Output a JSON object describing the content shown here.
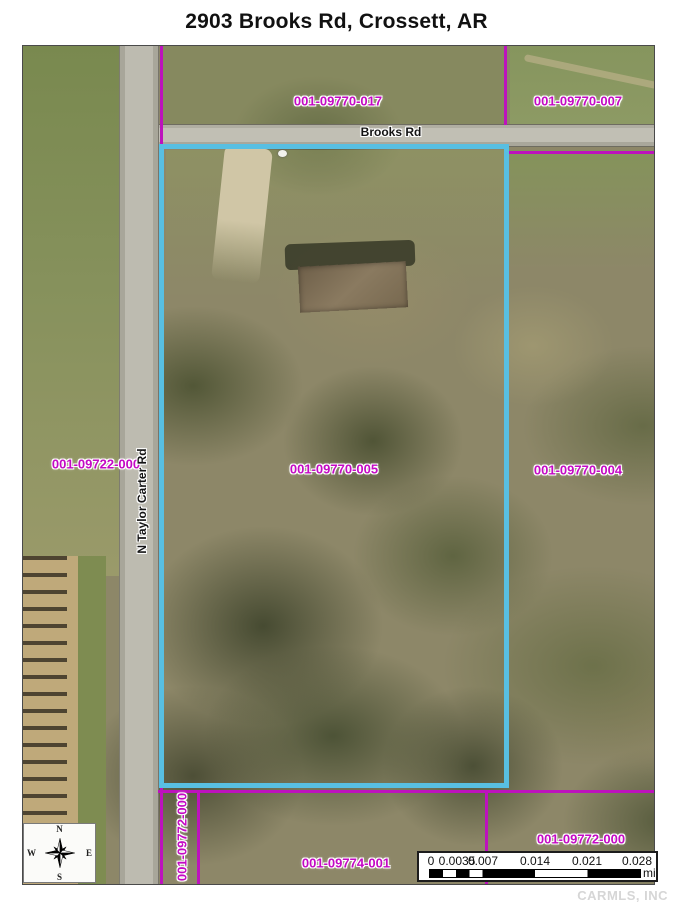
{
  "title": "2903 Brooks Rd, Crossett, AR",
  "parcels": {
    "topleft": "001-09770-017",
    "topright": "001-09770-007",
    "west": "001-09722-000",
    "subject": "001-09770-005",
    "east": "001-09770-004",
    "south_strip": "001-09772-000",
    "south": "001-09774-001",
    "southeast": "001-09772-000"
  },
  "roads": {
    "brooks": "Brooks Rd",
    "taylor_carter": "N Taylor Carter Rd"
  },
  "compass": {
    "north": "N",
    "south": "S",
    "east": "E",
    "west": "W"
  },
  "scalebar": {
    "ticks": [
      "0",
      "0.0035",
      "0.007",
      "0.014",
      "0.021",
      "0.028"
    ],
    "unit": "mi"
  },
  "watermark": "CARMLS, INC",
  "colors": {
    "parcel_line": "#bd12bd",
    "parcel_label": "#c408c4",
    "subject_boundary": "#58bfe2"
  }
}
